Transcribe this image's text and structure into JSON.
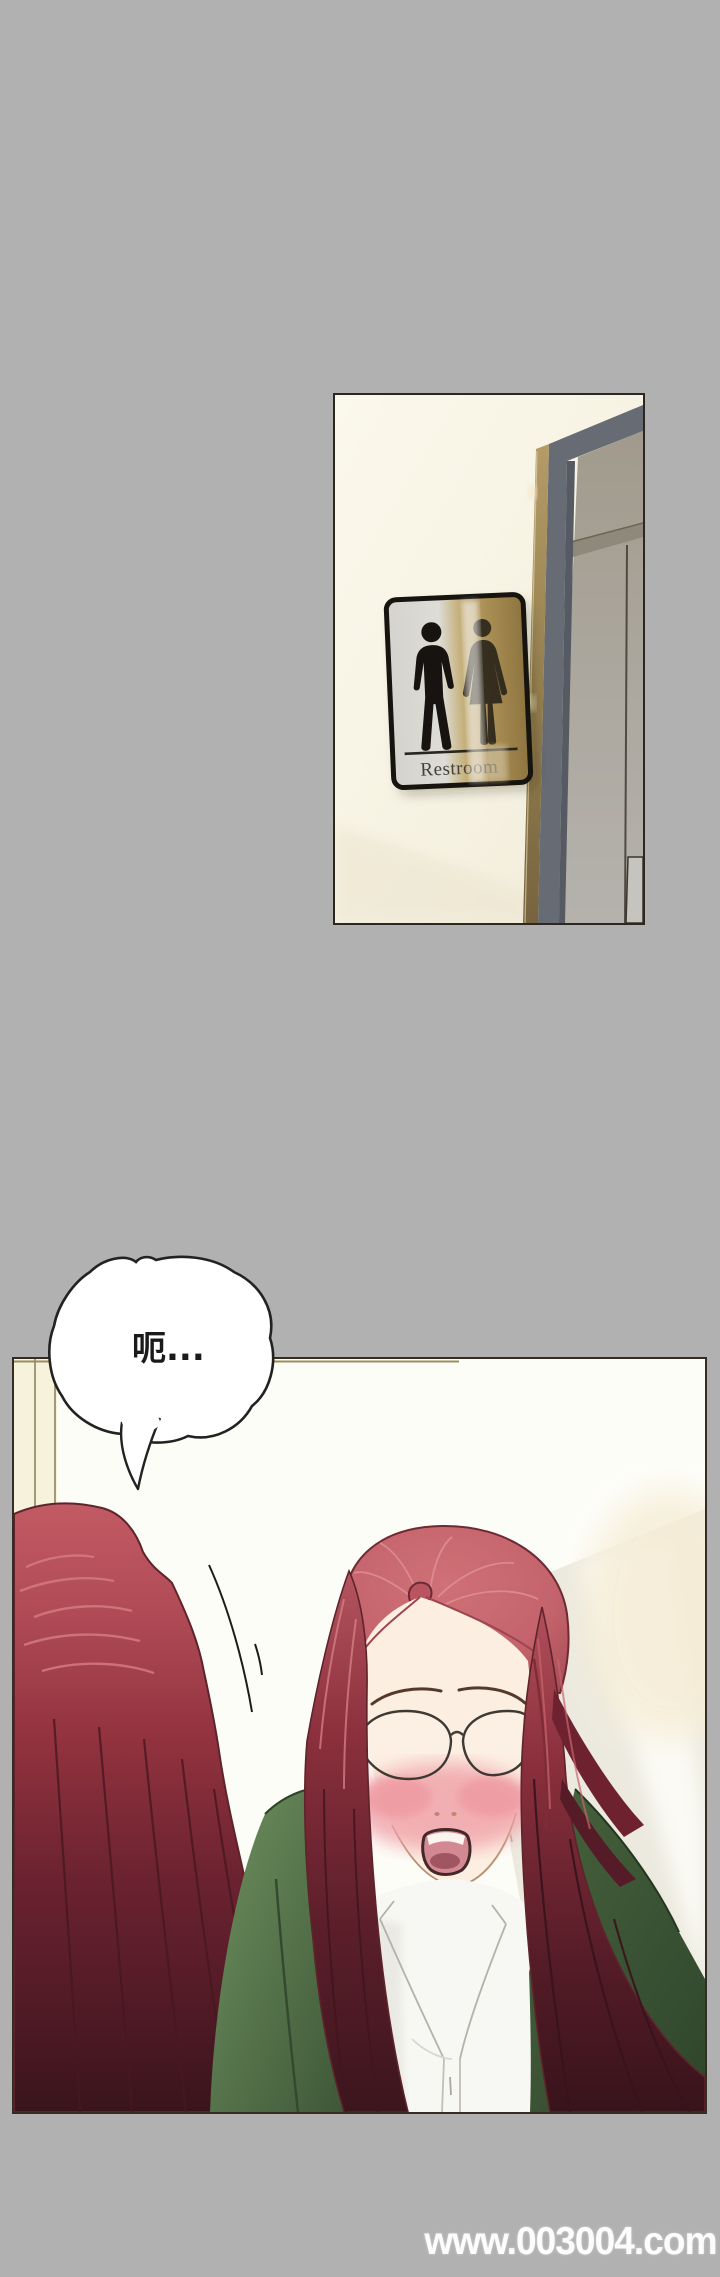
{
  "page": {
    "background_color": "#b1b1b1",
    "width": 720,
    "height": 2277
  },
  "watermark": {
    "text": "www.003004.com",
    "color": "#ffffff"
  },
  "panel_restroom": {
    "type": "photo-panel",
    "sign": {
      "label": "Restroom",
      "icons": [
        "male-figure",
        "female-figure"
      ],
      "plate_silver": "#d6d4cc",
      "plate_gold": "#ab9055",
      "border_color": "#17140f"
    },
    "wall_color": "#f8f4e6",
    "door_frame_color": "#666b74",
    "door_trim_color": "#a08a57",
    "door_glass_color": "#aaa59b"
  },
  "panel_mirror": {
    "type": "illustration-panel",
    "speech_bubble": {
      "text": "呃...",
      "fill": "#ffffff",
      "stroke": "#222222"
    },
    "character": {
      "hair_bright": "#c4636b",
      "hair_mid": "#8c303d",
      "hair_dark": "#3c151d",
      "jacket_green": "#567247",
      "shirt_white": "#f7f7f3",
      "skin": "#fcefe2",
      "blush": "#f0a0a8",
      "has_glasses": true
    },
    "wall_color": "#fdfdf8",
    "accent_strip_color": "#f6f2dc"
  }
}
